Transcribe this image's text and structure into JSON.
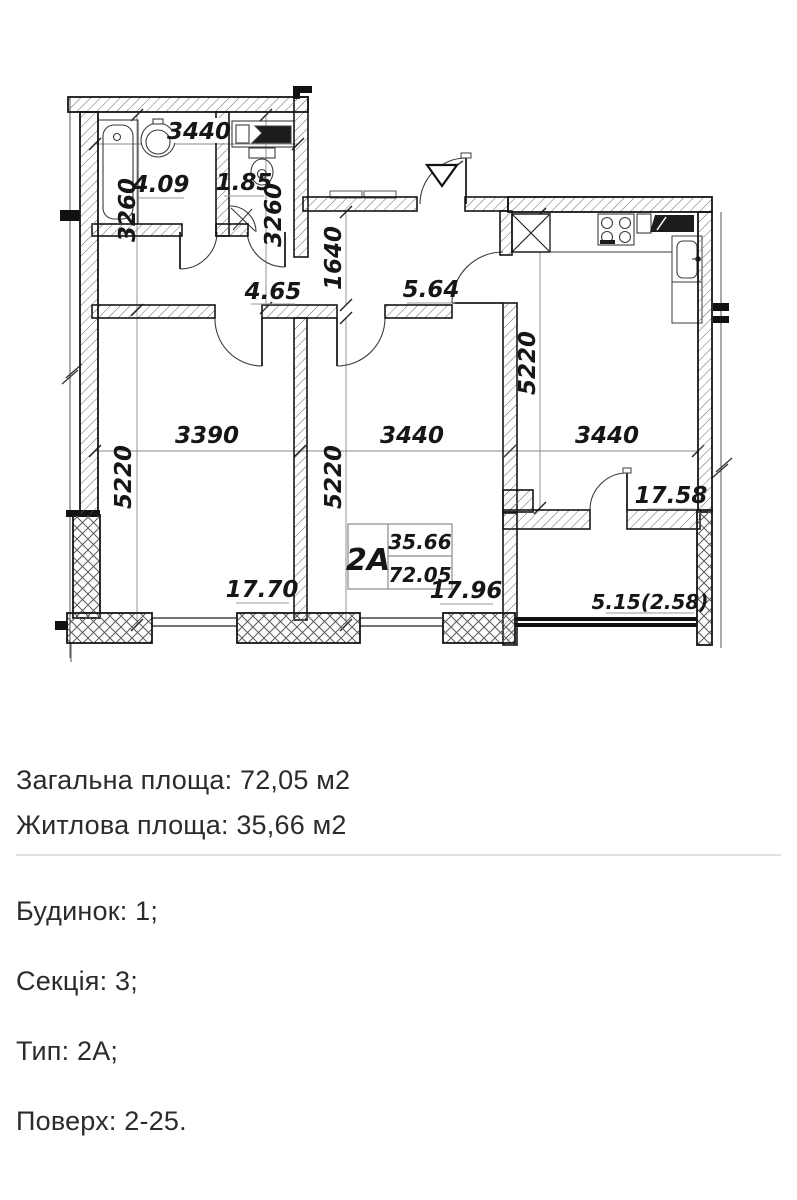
{
  "details": {
    "total_area": "Загальна площа: 72,05 м2",
    "living_area": "Житлова площа: 35,66 м2",
    "building": "Будинок: 1;",
    "section": "Секція: 3;",
    "unit_type": "Тип: 2А;",
    "floors": "Поверх: 2-25."
  },
  "plan": {
    "unit_box": {
      "type": "2А",
      "living_area": "35.66",
      "total_area": "72.05"
    },
    "dims": {
      "san_block_width": "3440",
      "bathroom_height": "3260",
      "wc_height": "3260",
      "hall_width": "1640",
      "bedroom1_width": "3390",
      "bedroom2_width": "3440",
      "kitchen_width": "3440",
      "bedroom1_height": "5220",
      "bedroom2_height": "5220",
      "kitchen_height": "5220"
    },
    "areas": {
      "bathroom": "4.09",
      "wc": "1.85",
      "hall_left": "4.65",
      "hall_right": "5.64",
      "bedroom1": "17.70",
      "bedroom2": "17.96",
      "kitchen_living": "17.58",
      "balcony": "5.15(2.58)"
    }
  },
  "colors": {
    "ink": "#1b1b1b",
    "divider": "#e2e2e2",
    "background": "#ffffff"
  }
}
